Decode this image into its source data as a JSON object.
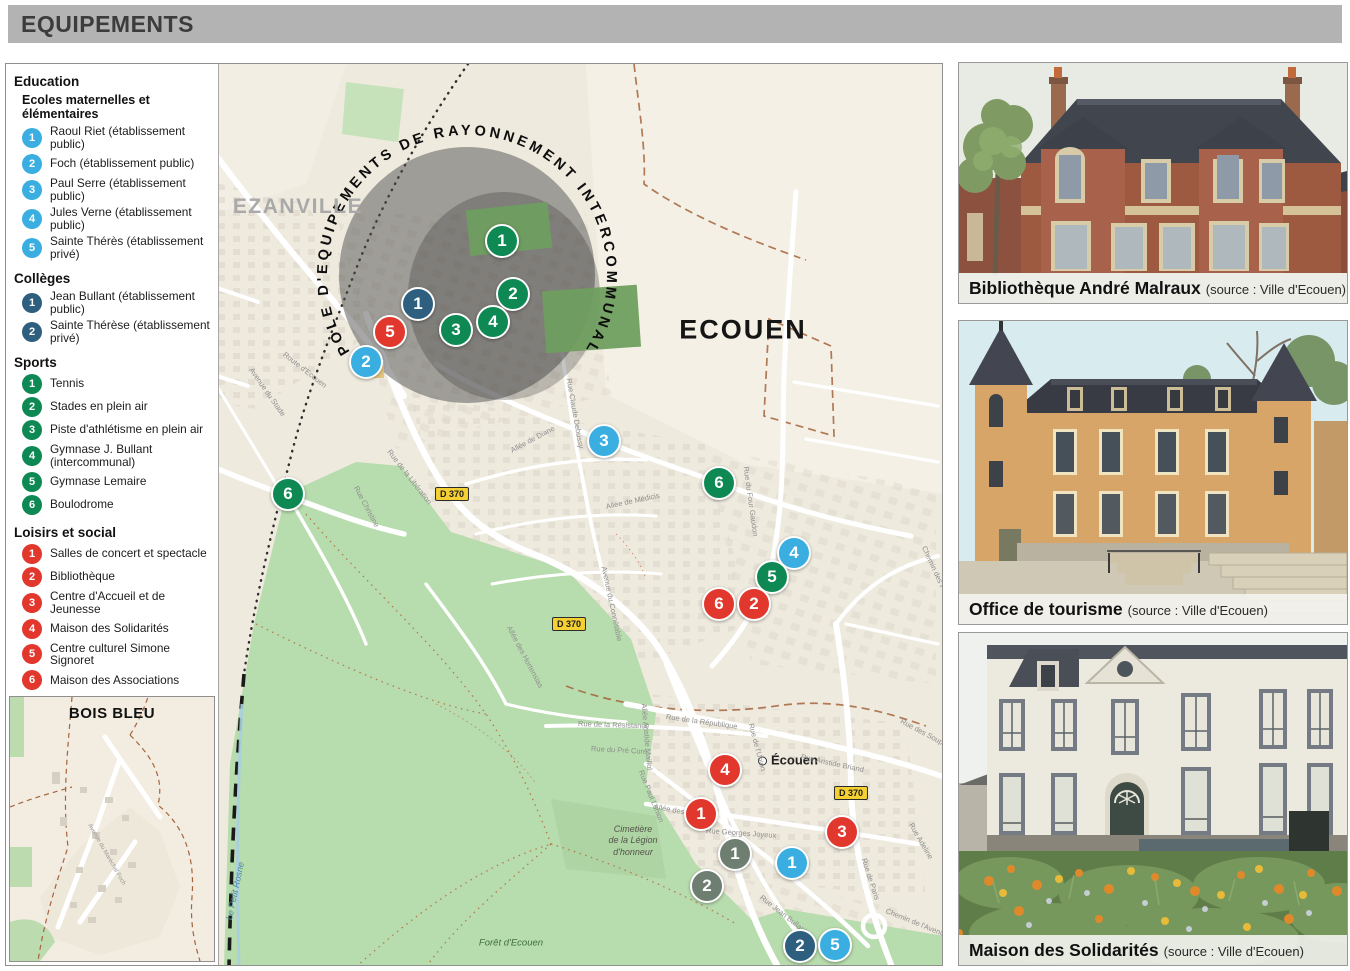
{
  "title": "EQUIPEMENTS",
  "colors": {
    "education": "#3aaee0",
    "colleges": "#2e5f7e",
    "sports": "#0e8953",
    "loisirs": "#e2372d",
    "tourisme": "#6e7e71"
  },
  "legend": {
    "sections": [
      {
        "id": "education",
        "heading": "Education",
        "subheading": "Ecoles maternelles et élémentaires",
        "items": [
          {
            "num": "1",
            "label": "Raoul Riet (établissement public)"
          },
          {
            "num": "2",
            "label": "Foch (établissement public)"
          },
          {
            "num": "3",
            "label": "Paul Serre (établissement public)"
          },
          {
            "num": "4",
            "label": "Jules Verne (établissement public)"
          },
          {
            "num": "5",
            "label": "Sainte Thérès (établissement privé)"
          }
        ]
      },
      {
        "id": "colleges",
        "heading": "Collèges",
        "items": [
          {
            "num": "1",
            "label": "Jean Bullant (établissement public)"
          },
          {
            "num": "2",
            "label": "Sainte Thérèse (établissement privé)"
          }
        ]
      },
      {
        "id": "sports",
        "heading": "Sports",
        "items": [
          {
            "num": "1",
            "label": "Tennis"
          },
          {
            "num": "2",
            "label": "Stades en plein air"
          },
          {
            "num": "3",
            "label": "Piste d'athlétisme en plein air"
          },
          {
            "num": "4",
            "label": "Gymnase J. Bullant (intercommunal)"
          },
          {
            "num": "5",
            "label": "Gymnase Lemaire"
          },
          {
            "num": "6",
            "label": "Boulodrome"
          }
        ]
      },
      {
        "id": "loisirs",
        "heading": "Loisirs et social",
        "items": [
          {
            "num": "1",
            "label": "Salles de concert et spectacle"
          },
          {
            "num": "2",
            "label": "Bibliothèque"
          },
          {
            "num": "3",
            "label": "Centre d'Accueil et de Jeunesse"
          },
          {
            "num": "4",
            "label": "Maison des Solidarités"
          },
          {
            "num": "5",
            "label": "Centre culturel Simone Signoret"
          },
          {
            "num": "6",
            "label": "Maison des Associations"
          }
        ]
      },
      {
        "id": "tourisme",
        "heading": "Tourisme",
        "items": [
          {
            "num": "1",
            "label": "Office de tourisme communal"
          },
          {
            "num": "2",
            "label": "Musée nationale de la Renaissance"
          }
        ]
      }
    ],
    "inset_title": "BOIS BLEU"
  },
  "map": {
    "pole_label": "POLE D'EQUIPEMENTS DE RAYONNEMENT INTERCOMMUNAL",
    "labels": {
      "ezanville": "EZANVILLE",
      "ecouen": "ECOUEN",
      "ecouen_small": "Écouen",
      "cemetery": "Cimetière\nde la Légion\nd'honneur",
      "forest": "Forêt d'Ecouen",
      "stream": "Le Petit Rosne"
    },
    "road_signs": [
      {
        "label": "D 370",
        "x": 446,
        "y": 430
      },
      {
        "label": "D 370",
        "x": 563,
        "y": 560
      },
      {
        "label": "D 370",
        "x": 845,
        "y": 729
      }
    ],
    "road_labels": [
      {
        "text": "Rue de la Libération",
        "x": 383,
        "y": 382,
        "rot": 52
      },
      {
        "text": "Rue Christine",
        "x": 350,
        "y": 418,
        "rot": 62
      },
      {
        "text": "Route d'Ecouen",
        "x": 278,
        "y": 285,
        "rot": 38
      },
      {
        "text": "Rue du Stade",
        "x": 118,
        "y": 382,
        "rot": 18
      },
      {
        "text": "Avenue du Stade",
        "x": 245,
        "y": 300,
        "rot": 55
      },
      {
        "text": "Rue Claude Debussy",
        "x": 563,
        "y": 310,
        "rot": 80
      },
      {
        "text": "Allée de Diane",
        "x": 505,
        "y": 382,
        "rot": -28
      },
      {
        "text": "Allée de Médicis",
        "x": 600,
        "y": 438,
        "rot": -12
      },
      {
        "text": "Avenue du Connétable",
        "x": 598,
        "y": 498,
        "rot": 78
      },
      {
        "text": "Allée des Hortensias",
        "x": 503,
        "y": 558,
        "rot": 62
      },
      {
        "text": "Rue de la Résistance",
        "x": 572,
        "y": 655,
        "rot": 2
      },
      {
        "text": "Rue du Pré Curé",
        "x": 585,
        "y": 680,
        "rot": 3
      },
      {
        "text": "Rue de la République",
        "x": 660,
        "y": 648,
        "rot": 8
      },
      {
        "text": "Rue du Four Gaudon",
        "x": 740,
        "y": 398,
        "rot": 82
      },
      {
        "text": "Chemin des Palissiers",
        "x": 918,
        "y": 478,
        "rot": 65
      },
      {
        "text": "Rue Aristide Briand",
        "x": 795,
        "y": 688,
        "rot": 12
      },
      {
        "text": "Rue Georges Joyeux",
        "x": 700,
        "y": 762,
        "rot": 4
      },
      {
        "text": "Rue Paul Lonion",
        "x": 635,
        "y": 702,
        "rot": 68
      },
      {
        "text": "Allée Aristide Maillol",
        "x": 638,
        "y": 635,
        "rot": 85
      },
      {
        "text": "Rue de Paris",
        "x": 858,
        "y": 790,
        "rot": 72
      },
      {
        "text": "Rue Adeline",
        "x": 905,
        "y": 755,
        "rot": 60
      },
      {
        "text": "Rue des Soupirs",
        "x": 895,
        "y": 652,
        "rot": 28
      },
      {
        "text": "Rue de l'Union",
        "x": 745,
        "y": 655,
        "rot": 75
      },
      {
        "text": "Rue Jean Bullant",
        "x": 755,
        "y": 828,
        "rot": 38
      },
      {
        "text": "Chemin de l'Avenir",
        "x": 880,
        "y": 842,
        "rot": 22
      },
      {
        "text": "Allée des Pins",
        "x": 648,
        "y": 738,
        "rot": 10
      }
    ],
    "markers": [
      {
        "cat": "sports",
        "num": "1",
        "x": 496,
        "y": 177
      },
      {
        "cat": "sports",
        "num": "2",
        "x": 507,
        "y": 230
      },
      {
        "cat": "colleges",
        "num": "1",
        "x": 412,
        "y": 240
      },
      {
        "cat": "sports",
        "num": "4",
        "x": 487,
        "y": 258
      },
      {
        "cat": "sports",
        "num": "3",
        "x": 450,
        "y": 266
      },
      {
        "cat": "loisirs",
        "num": "5",
        "x": 384,
        "y": 268
      },
      {
        "cat": "education",
        "num": "2",
        "x": 360,
        "y": 298
      },
      {
        "cat": "education",
        "num": "3",
        "x": 598,
        "y": 377
      },
      {
        "cat": "sports",
        "num": "6",
        "x": 282,
        "y": 430
      },
      {
        "cat": "sports",
        "num": "6",
        "x": 713,
        "y": 419
      },
      {
        "cat": "education",
        "num": "4",
        "x": 788,
        "y": 489
      },
      {
        "cat": "sports",
        "num": "5",
        "x": 766,
        "y": 513
      },
      {
        "cat": "loisirs",
        "num": "6",
        "x": 713,
        "y": 540
      },
      {
        "cat": "loisirs",
        "num": "2",
        "x": 748,
        "y": 540
      },
      {
        "cat": "loisirs",
        "num": "4",
        "x": 719,
        "y": 706
      },
      {
        "cat": "loisirs",
        "num": "1",
        "x": 695,
        "y": 750
      },
      {
        "cat": "loisirs",
        "num": "3",
        "x": 836,
        "y": 768
      },
      {
        "cat": "tourisme",
        "num": "1",
        "x": 729,
        "y": 790
      },
      {
        "cat": "education",
        "num": "1",
        "x": 786,
        "y": 799
      },
      {
        "cat": "tourisme",
        "num": "2",
        "x": 701,
        "y": 822
      },
      {
        "cat": "colleges",
        "num": "2",
        "x": 794,
        "y": 882
      },
      {
        "cat": "education",
        "num": "5",
        "x": 829,
        "y": 881
      }
    ]
  },
  "photos": [
    {
      "title": "Bibliothèque André Malraux",
      "source": "(source : Ville d'Ecouen)"
    },
    {
      "title": "Office de tourisme",
      "source": "(source : Ville d'Ecouen)"
    },
    {
      "title": "Maison des Solidarités",
      "source": "(source : Ville d'Ecouen)"
    }
  ]
}
